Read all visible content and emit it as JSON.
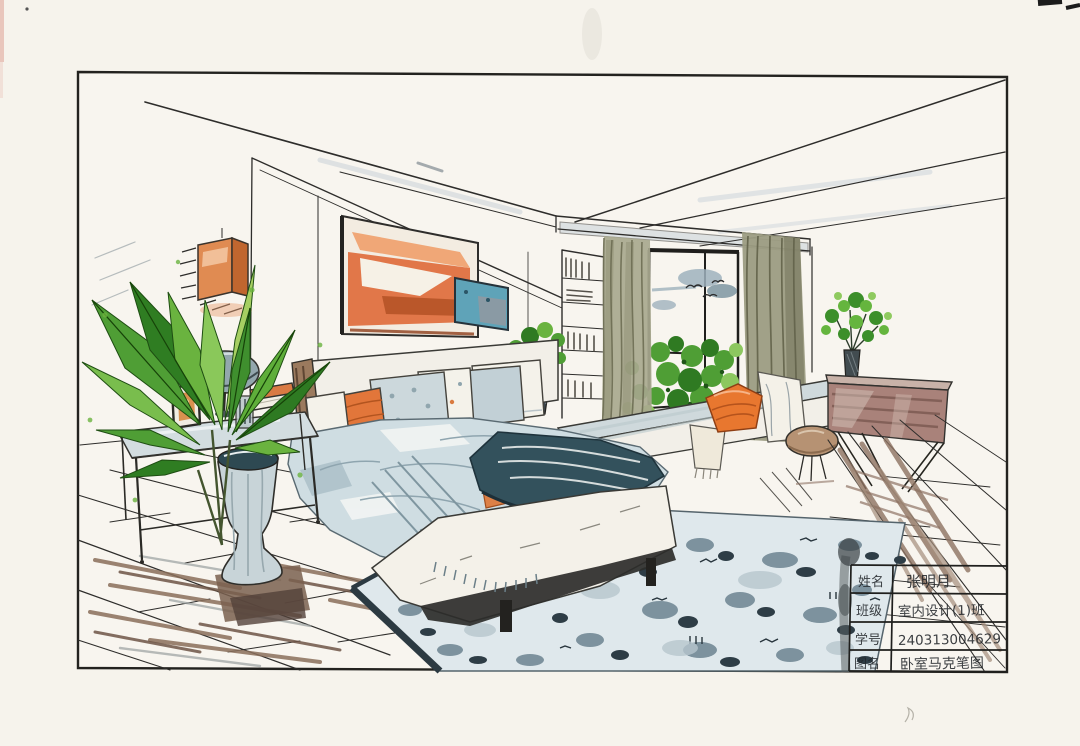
{
  "page": {
    "title": "Bedroom interior marker rendering (hand-drawn presentation sheet)"
  },
  "artwork": {
    "type": "hand-drawn marker / watercolor interior perspective sketch",
    "scene": "bedroom in two-point perspective with bed, window seat, console, plants and area rug"
  },
  "title_block": {
    "rows": [
      {
        "label": "姓名",
        "value": "张明月"
      },
      {
        "label": "班级",
        "value": "室内设计(1)班"
      },
      {
        "label": "学号",
        "value": "240313004629"
      },
      {
        "label": "图名",
        "value": "卧室马克笔图"
      }
    ]
  },
  "palette": {
    "paper": "#f6f3ec",
    "ink": "#2e2d2b",
    "accent_orange": "#e0763a",
    "deep_orange": "#b5531c",
    "teal_blanket": "#33515c",
    "duvet_blue": "#cfdde2",
    "rug_light": "#dfe8ec",
    "rug_dark": "#2c3a42",
    "leaf_green": "#4f9e35",
    "leaf_dark": "#2f7a22",
    "curtain_olive": "#a8a88e",
    "console_mauve": "#a9827a",
    "floor_brown": "#8a6f5b",
    "lamp_gray": "#93a7ad"
  }
}
